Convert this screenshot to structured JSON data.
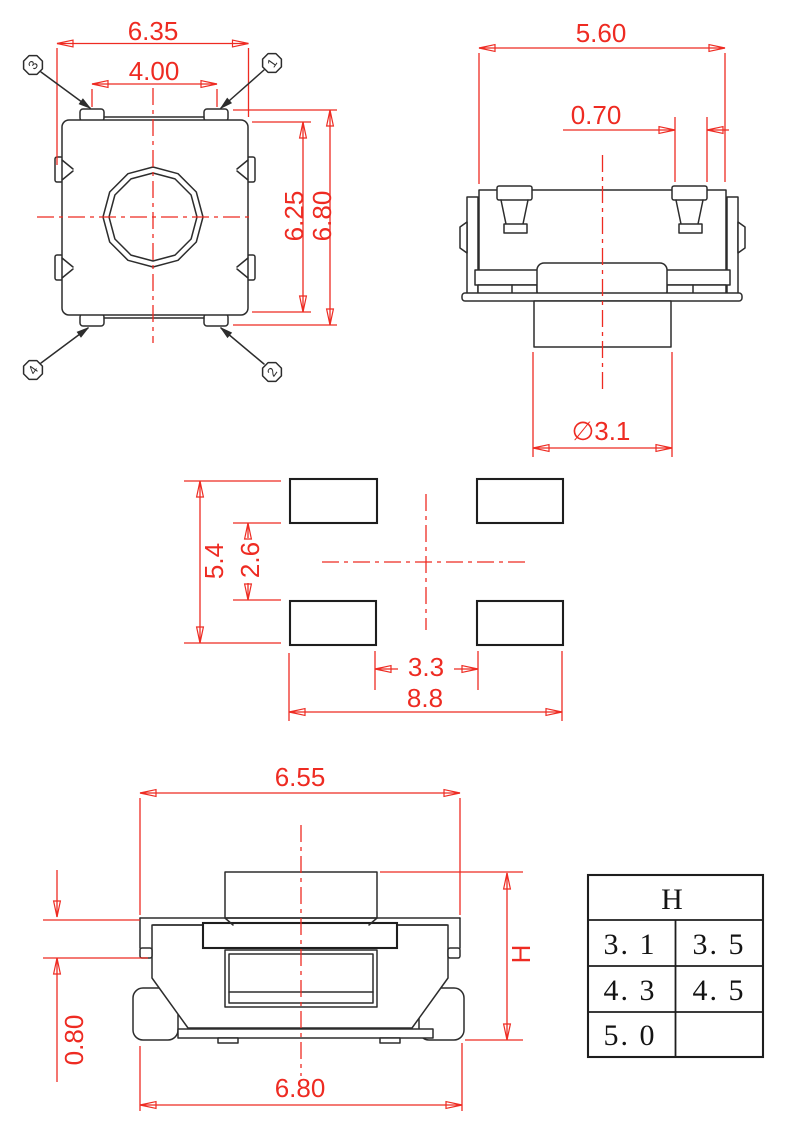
{
  "drawing": {
    "type": "tactile-switch-dimension-drawing",
    "colors": {
      "dimension_red": "#ee2b22",
      "outline_black": "#2d2d2d",
      "background": "#ffffff"
    }
  },
  "views": {
    "top": {
      "dim_width": "6.35",
      "dim_button": "4.00",
      "dim_body_height": "6.25",
      "dim_overall_height": "6.80",
      "pins": {
        "tl": "3",
        "tr": "1",
        "bl": "4",
        "br": "2"
      }
    },
    "side": {
      "dim_width": "5.60",
      "dim_terminal": "0.70",
      "dim_stem": "∅3.1"
    },
    "land": {
      "dim_v_outer": "5.4",
      "dim_v_inner": "2.6",
      "dim_h_inner": "3.3",
      "dim_h_outer": "8.8"
    },
    "front": {
      "dim_top_width": "6.55",
      "dim_bottom_width": "6.80",
      "dim_step": "0.80",
      "dim_height": "H"
    },
    "table": {
      "header": "H",
      "rows": [
        [
          "3. 1",
          "3. 5"
        ],
        [
          "4. 3",
          "4. 5"
        ],
        [
          "5. 0",
          ""
        ]
      ]
    }
  }
}
